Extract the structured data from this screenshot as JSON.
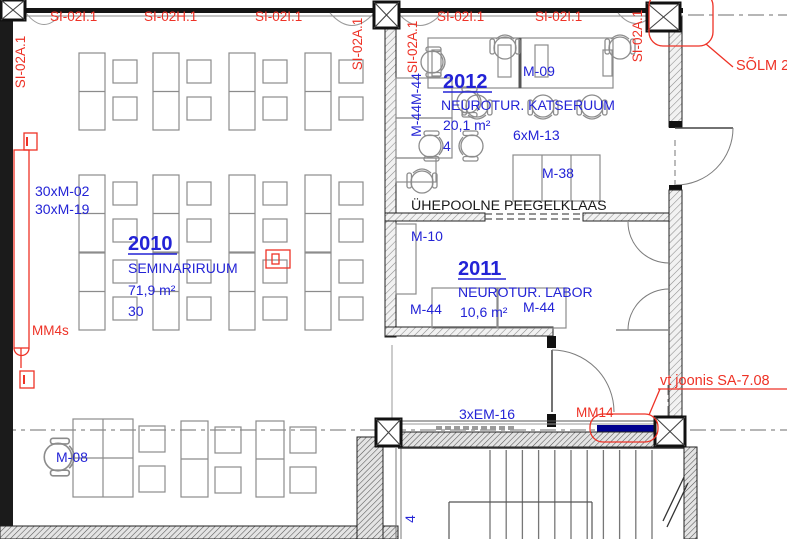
{
  "colors": {
    "label_blue": "#2323d6",
    "annotation_red": "#ee3226",
    "mm14_bar": "#00008f"
  },
  "window_labels": {
    "v_left": "SI-02A.1",
    "h1": "SI-02I.1",
    "h2": "SI-02H.1",
    "h3": "SI-02I.1",
    "v_mid_left": "SI-02A.1",
    "v_mid_right": "SI-02A.1",
    "h4": "SI-02I.1",
    "h5": "SI-02I.1",
    "v_right": "SI-02A.1"
  },
  "annotations": {
    "solm": "SÕLM 2",
    "mm4s": "MM4s",
    "mm14": "MM14",
    "vt_joonis": "vt joonis SA-7.08",
    "glass_note": "ÜHEPOOLNE PEEGELKLAAS"
  },
  "rooms": {
    "r2010": {
      "number": "2010",
      "name": "SEMINARIRUUM",
      "area": "71,9 m²",
      "capacity": "30",
      "count_label_1": "30xM-02",
      "count_label_2": "30xM-19"
    },
    "r2011": {
      "number": "2011",
      "name": "NEUROTUR. LABOR",
      "area": "10,6 m²",
      "label_m10": "M-10",
      "label_m44_left": "M-44",
      "label_m44_right": "M-44"
    },
    "r2012": {
      "number": "2012",
      "name": "NEUROTUR. KATSERUUM",
      "area": "20,1 m²",
      "capacity": "4",
      "label_m09": "M-09",
      "label_m13": "6xM-13",
      "label_m38": "M-38",
      "label_m44_vertical": "M-44M-44"
    }
  },
  "corridor": {
    "label_m08": "M-08",
    "label_em16": "3xEM-16",
    "label_stair_vertical": "4"
  }
}
